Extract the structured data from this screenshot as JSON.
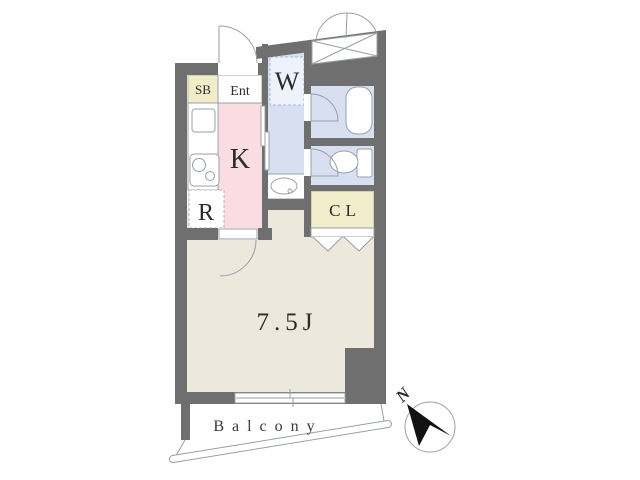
{
  "floorplan": {
    "type": "japanese-apartment-floor-plan",
    "rooms": {
      "shoe_box": "SB",
      "entrance": "Ent",
      "kitchen": "K",
      "refrigerator_space": "R",
      "washer_space": "W",
      "closet": "CL",
      "main_room_size": "7.5J",
      "balcony": "Balcony"
    },
    "compass": {
      "north": "N"
    },
    "icons": {
      "kitchen_fixtures": [
        "sink-icon",
        "stove-icon"
      ],
      "wet_area_fixtures": [
        "washbasin-icon",
        "bathtub-icon",
        "toilet-icon"
      ],
      "exterior": [
        "storage-box-icon",
        "double-swing-door-icon",
        "north-arrow-icon"
      ],
      "openings": [
        "entrance-door-arc",
        "room-door-arc",
        "bath-door-arc",
        "toilet-door-arc",
        "sliding-door",
        "folding-door-chevrons",
        "sliding-window"
      ]
    },
    "colors": {
      "wall": "#6f6f6f",
      "floor": "#ece8dc",
      "kitchen": "#fadde2",
      "closet": "#f1edca",
      "wet": "#d7dff0",
      "washerbox": "#eef2fb",
      "line": "#9aa0a6",
      "ink": "#2b2b2b"
    }
  }
}
